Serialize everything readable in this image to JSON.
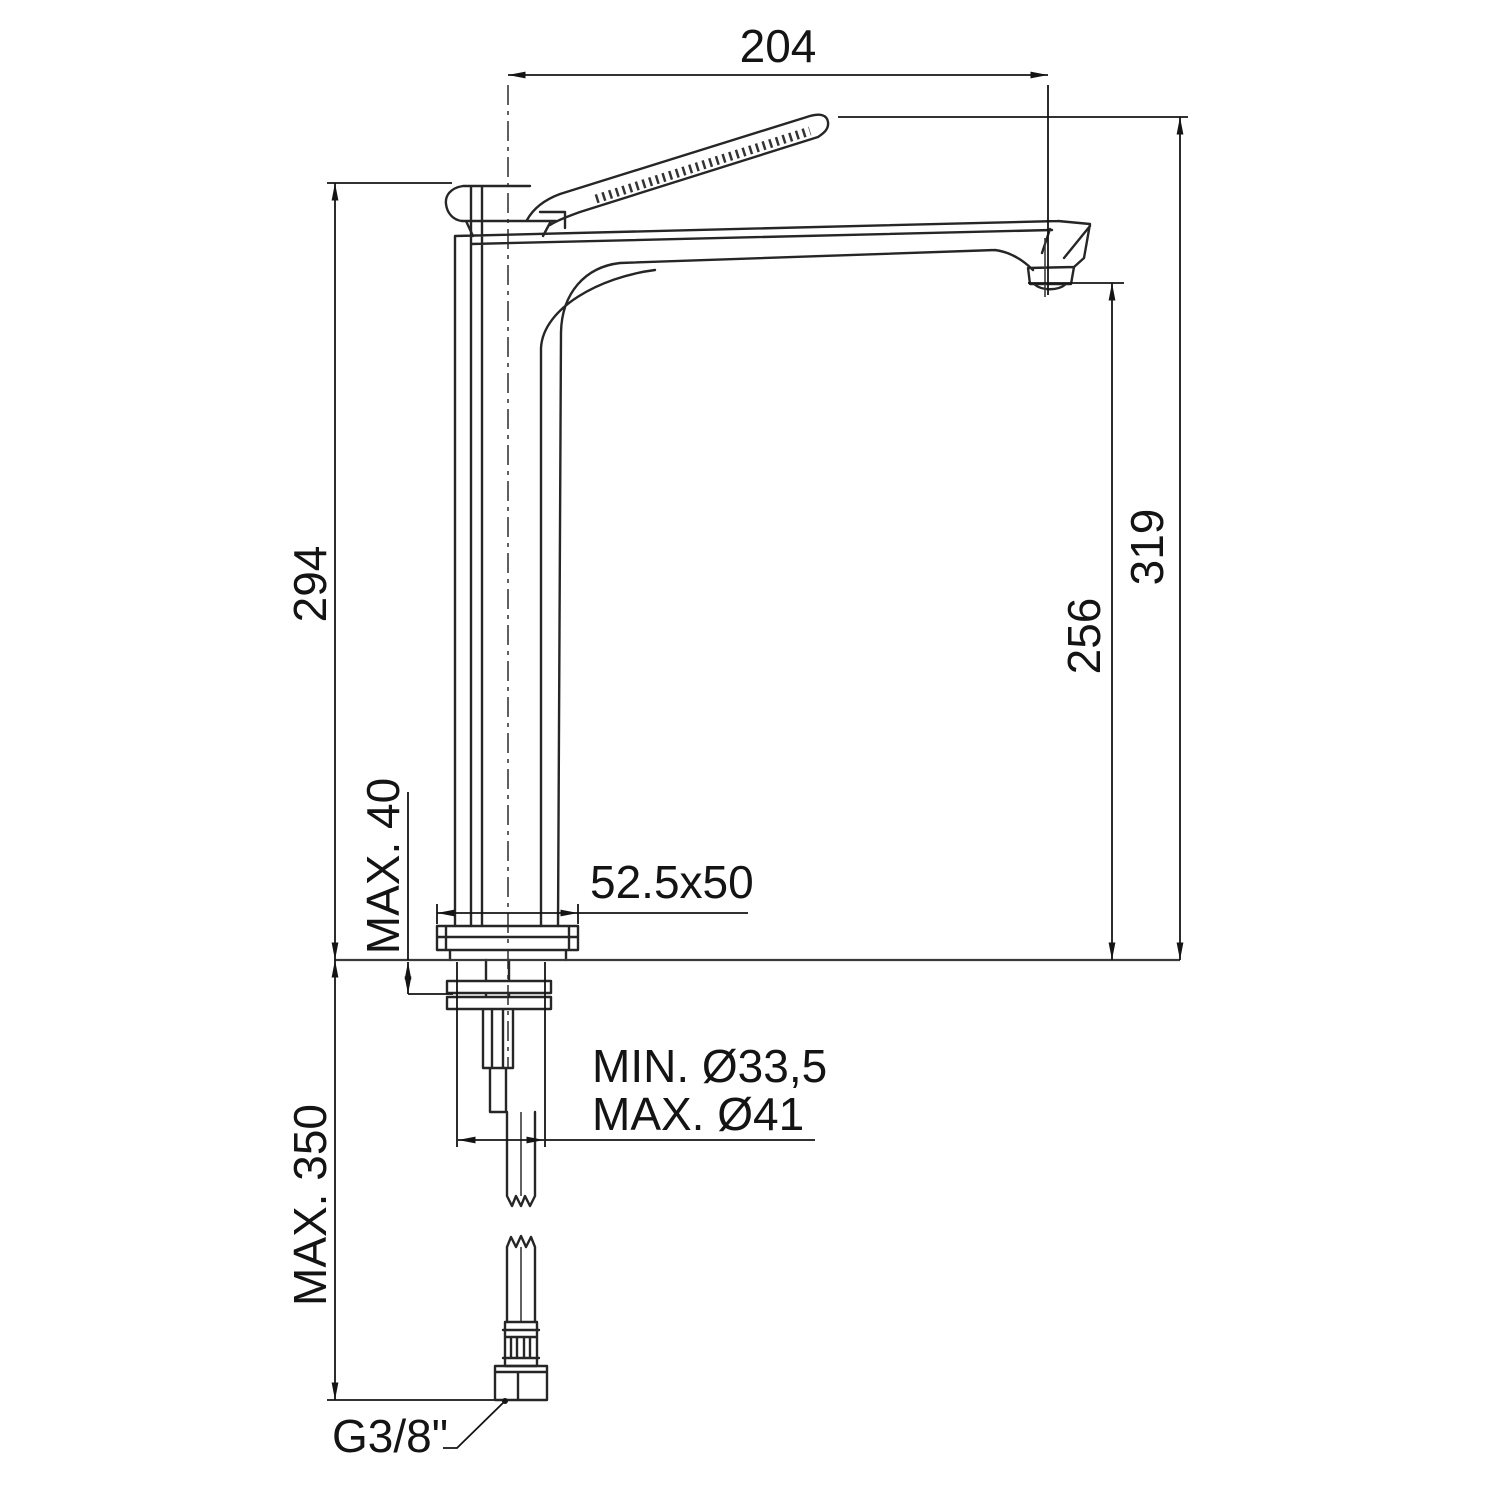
{
  "labels": {
    "spout_reach": "204",
    "body_height": "294",
    "total_height": "319",
    "spout_outlet_height": "256",
    "deck_thickness": "MAX. 40",
    "base_plate_size": "52.5x50",
    "hole_min_diameter": "MIN. Ø33,5",
    "hole_max_diameter": "MAX. Ø41",
    "hose_max_length": "MAX. 350",
    "thread_size": "G3/8\""
  },
  "colors": {
    "background": "#ffffff",
    "drawing_line": "#262626",
    "dimension_line": "#141414"
  }
}
